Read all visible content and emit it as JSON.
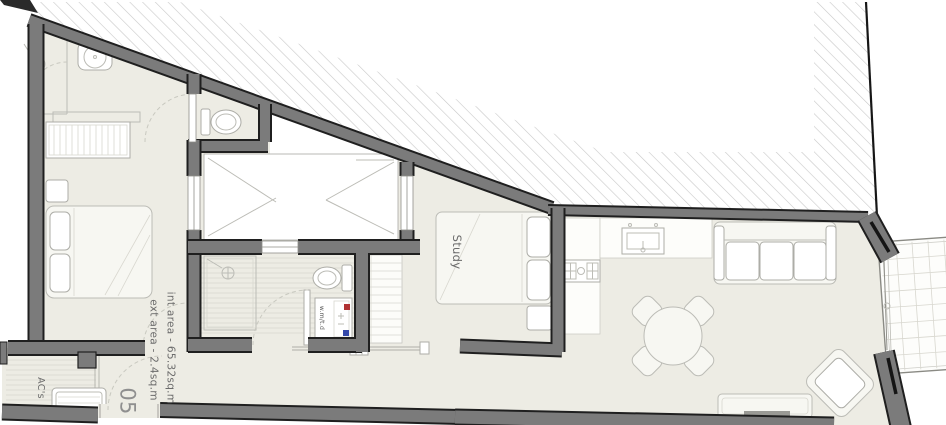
{
  "plan": {
    "rooms": {
      "study": "Study"
    },
    "labels": {
      "int_area": "int area - 65.32sq.m",
      "ext_area": "ext area - 2.4sq.m",
      "unit_number": "05",
      "ac": "AC's",
      "washer": "w.m/t.d"
    },
    "colors": {
      "wall": "#7b7b7b",
      "floor": "#edece4",
      "hatch_line": "#c8c8c8",
      "hot": "#b03232",
      "cold": "#3448aa",
      "text": "#6b6b6b"
    }
  }
}
